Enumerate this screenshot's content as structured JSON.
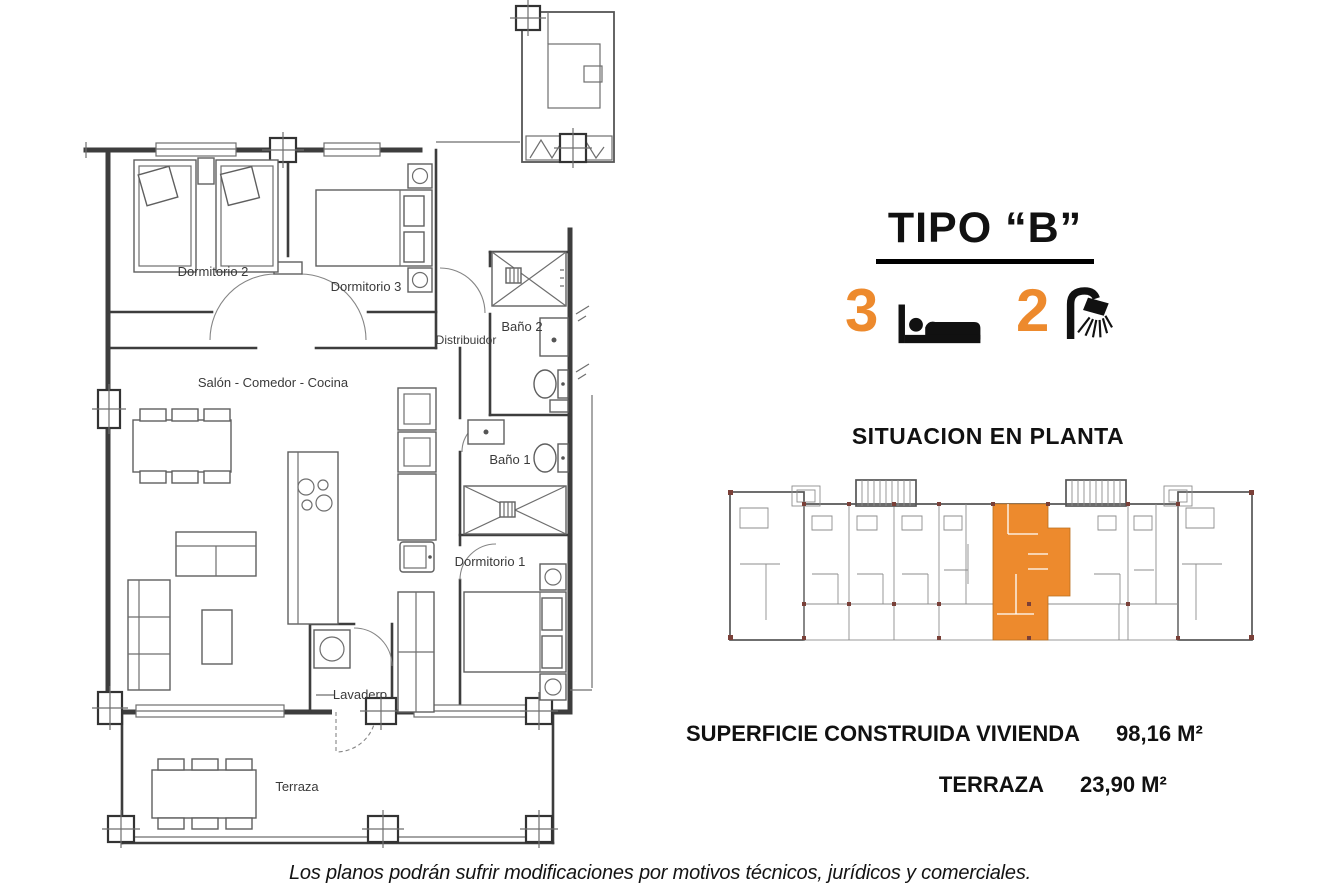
{
  "header": {
    "title": "TIPO “B”"
  },
  "features": {
    "bedrooms": {
      "count": "3",
      "icon": "bed-icon"
    },
    "bathrooms": {
      "count": "2",
      "icon": "shower-icon"
    }
  },
  "situation": {
    "title": "SITUACION EN PLANTA"
  },
  "surfaces": [
    {
      "label": "SUPERFICIE CONSTRUIDA VIVIENDA",
      "value": "98,16 M²"
    },
    {
      "label": "TERRAZA",
      "value": "23,90 M²"
    }
  ],
  "floorplan": {
    "rooms": [
      {
        "label": "Dormitorio 2"
      },
      {
        "label": "Dormitorio 3"
      },
      {
        "label": "Distribuidor"
      },
      {
        "label": "Baño 2"
      },
      {
        "label": "Salón - Comedor - Cocina"
      },
      {
        "label": "Baño 1"
      },
      {
        "label": "Dormitorio 1"
      },
      {
        "label": "Lavadero"
      },
      {
        "label": "Terraza"
      }
    ]
  },
  "footer": {
    "disclaimer": "Los planos podrán sufrir modificaciones por motivos técnicos, jurídicos y comerciales."
  },
  "colors": {
    "accent": "#ED8A2D",
    "plan_line": "#3d3d3d"
  }
}
